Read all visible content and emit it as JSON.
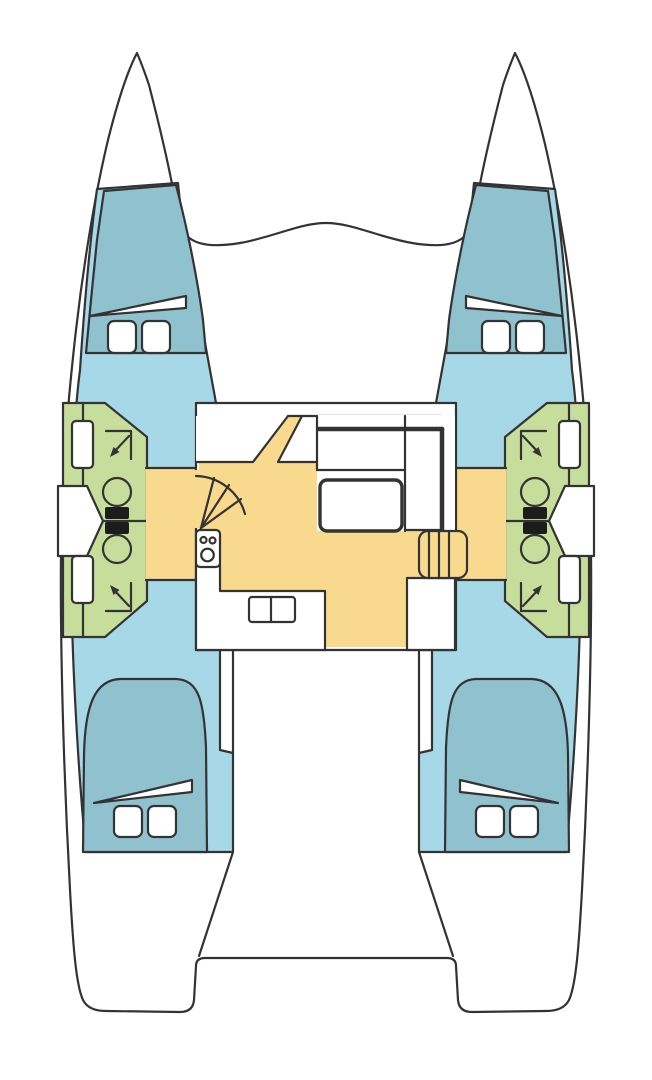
{
  "canvas": {
    "width": 652,
    "height": 1080,
    "background": "#ffffff"
  },
  "colors": {
    "outline": "#333333",
    "hull_white": "#ffffff",
    "cabin_floor_blue": "#a7d8e8",
    "berth_teal": "#8fc2ce",
    "bathroom_green": "#c6dd9b",
    "salon_yellow": "#f8d98e",
    "fixture_white": "#ffffff",
    "toilet_seat_black": "#1c1c1c"
  },
  "legend": {
    "diagram_type": "catamaran floor plan, top-down, bow up",
    "hulls": [
      "port",
      "starboard"
    ],
    "areas": [
      {
        "name": "bow-peak",
        "count": 2
      },
      {
        "name": "trampoline-foredeck",
        "count": 1
      },
      {
        "name": "forward-cabin",
        "count": 2
      },
      {
        "name": "aft-cabin",
        "count": 2
      },
      {
        "name": "bathroom",
        "count": 4
      },
      {
        "name": "salon",
        "count": 1
      },
      {
        "name": "galley",
        "count": 1
      },
      {
        "name": "aft-platform",
        "count": 1
      }
    ],
    "fixtures": [
      {
        "name": "double-berth",
        "count": 4
      },
      {
        "name": "berth-pillow",
        "count": 8
      },
      {
        "name": "toilet",
        "count": 4
      },
      {
        "name": "shower",
        "count": 4
      },
      {
        "name": "washbasin",
        "count": 4
      },
      {
        "name": "stove-3-burner",
        "count": 1
      },
      {
        "name": "galley-sink",
        "count": 1
      },
      {
        "name": "dinette-table",
        "count": 1
      },
      {
        "name": "l-shaped-sofa",
        "count": 1
      },
      {
        "name": "companionway-stairs",
        "count": 2
      },
      {
        "name": "chart-seat-ramp",
        "count": 1
      }
    ]
  }
}
